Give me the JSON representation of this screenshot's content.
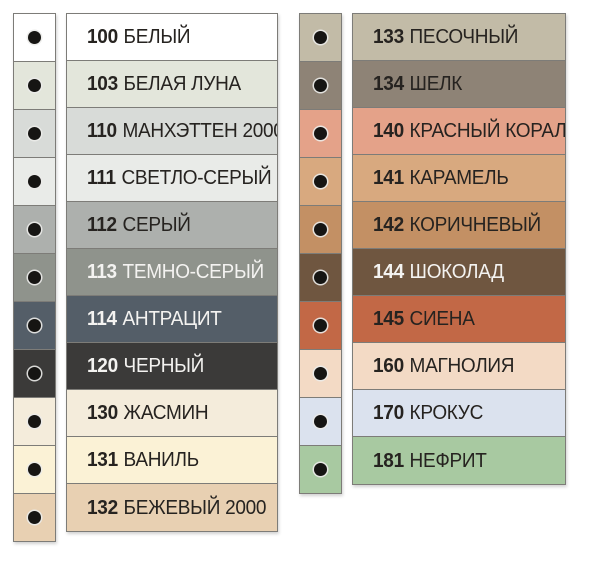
{
  "palette": {
    "background": "#ffffff",
    "line_color": "#7d7c78",
    "dark_text": "#262320",
    "light_text": "#f4f3f1",
    "dot_color": "#161513",
    "dot_ring_color": "#ebebe9"
  },
  "columns": [
    {
      "rows": [
        {
          "code": "100",
          "name": "БЕЛЫЙ",
          "color": "#ffffff",
          "text": "dark"
        },
        {
          "code": "103",
          "name": "БЕЛАЯ ЛУНА",
          "color": "#e3e6db",
          "text": "dark"
        },
        {
          "code": "110",
          "name": "МАНХЭТТЕН 2000",
          "color": "#d8dbd8",
          "text": "dark"
        },
        {
          "code": "111",
          "name": "СВЕТЛО-СЕРЫЙ",
          "color": "#e9ebe8",
          "text": "dark"
        },
        {
          "code": "112",
          "name": "СЕРЫЙ",
          "color": "#adb0ad",
          "text": "dark"
        },
        {
          "code": "113",
          "name": "ТЕМНО-СЕРЫЙ",
          "color": "#8f938c",
          "text": "light"
        },
        {
          "code": "114",
          "name": "АНТРАЦИТ",
          "color": "#545e68",
          "text": "light"
        },
        {
          "code": "120",
          "name": "ЧЕРНЫЙ",
          "color": "#3b3a39",
          "text": "light"
        },
        {
          "code": "130",
          "name": "ЖАСМИН",
          "color": "#f4ecdb",
          "text": "dark"
        },
        {
          "code": "131",
          "name": "ВАНИЛЬ",
          "color": "#fbf2d6",
          "text": "dark"
        },
        {
          "code": "132",
          "name": "БЕЖЕВЫЙ 2000",
          "color": "#e8d0b2",
          "text": "dark"
        }
      ]
    },
    {
      "rows": [
        {
          "code": "133",
          "name": "ПЕСОЧНЫЙ",
          "color": "#c2bba7",
          "text": "dark"
        },
        {
          "code": "134",
          "name": "ШЕЛК",
          "color": "#8e8376",
          "text": "dark"
        },
        {
          "code": "140",
          "name": "КРАСНЫЙ КОРАЛЛ",
          "color": "#e4a289",
          "text": "dark"
        },
        {
          "code": "141",
          "name": "КАРАМЕЛЬ",
          "color": "#d8a97f",
          "text": "dark"
        },
        {
          "code": "142",
          "name": "КОРИЧНЕВЫЙ",
          "color": "#c39064",
          "text": "dark"
        },
        {
          "code": "144",
          "name": "ШОКОЛАД",
          "color": "#6f5640",
          "text": "light"
        },
        {
          "code": "145",
          "name": "СИЕНА",
          "color": "#c26846",
          "text": "dark"
        },
        {
          "code": "160",
          "name": "МАГНОЛИЯ",
          "color": "#f3dac5",
          "text": "dark"
        },
        {
          "code": "170",
          "name": "КРОКУС",
          "color": "#dbe2ee",
          "text": "dark"
        },
        {
          "code": "181",
          "name": "НЕФРИТ",
          "color": "#a8c9a1",
          "text": "dark"
        }
      ]
    }
  ],
  "chart_data": {
    "type": "table",
    "title": "",
    "columns": [
      "code",
      "name",
      "swatch_color"
    ],
    "rows": [
      [
        "100",
        "БЕЛЫЙ",
        "#ffffff"
      ],
      [
        "103",
        "БЕЛАЯ ЛУНА",
        "#e3e6db"
      ],
      [
        "110",
        "МАНХЭТТЕН 2000",
        "#d8dbd8"
      ],
      [
        "111",
        "СВЕТЛО-СЕРЫЙ",
        "#e9ebe8"
      ],
      [
        "112",
        "СЕРЫЙ",
        "#adb0ad"
      ],
      [
        "113",
        "ТЕМНО-СЕРЫЙ",
        "#8f938c"
      ],
      [
        "114",
        "АНТРАЦИТ",
        "#545e68"
      ],
      [
        "120",
        "ЧЕРНЫЙ",
        "#3b3a39"
      ],
      [
        "130",
        "ЖАСМИН",
        "#f4ecdb"
      ],
      [
        "131",
        "ВАНИЛЬ",
        "#fbf2d6"
      ],
      [
        "132",
        "БЕЖЕВЫЙ 2000",
        "#e8d0b2"
      ],
      [
        "133",
        "ПЕСОЧНЫЙ",
        "#c2bba7"
      ],
      [
        "134",
        "ШЕЛК",
        "#8e8376"
      ],
      [
        "140",
        "КРАСНЫЙ КОРАЛЛ",
        "#e4a289"
      ],
      [
        "141",
        "КАРАМЕЛЬ",
        "#d8a97f"
      ],
      [
        "142",
        "КОРИЧНЕВЫЙ",
        "#c39064"
      ],
      [
        "144",
        "ШОКОЛАД",
        "#6f5640"
      ],
      [
        "145",
        "СИЕНА",
        "#c26846"
      ],
      [
        "160",
        "МАГНОЛИЯ",
        "#f3dac5"
      ],
      [
        "170",
        "КРОКУС",
        "#dbe2ee"
      ],
      [
        "181",
        "НЕФРИТ",
        "#a8c9a1"
      ]
    ]
  }
}
